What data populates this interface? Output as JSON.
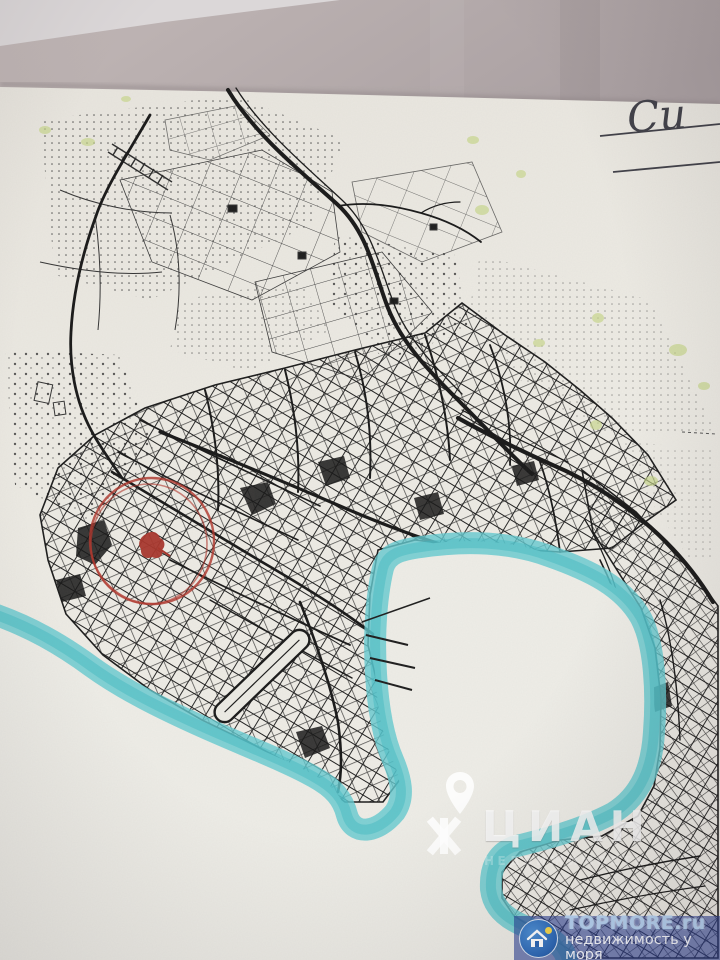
{
  "handwriting": {
    "text": "Си"
  },
  "watermarks": {
    "cian": {
      "text": "ЦИАН",
      "subtitle": "НЕДВИЖИМОСТЬ",
      "text_color": "#ffffff",
      "icons": [
        "location-pin-icon",
        "cian-logo-icon"
      ]
    },
    "topmore": {
      "site": "TOPMORE.ru",
      "tagline": "недвижимость у моря",
      "bar_color": "#2c3f94",
      "logo": "house-in-circle-icon"
    }
  },
  "map": {
    "water_highlight_color": "#5cc6cc",
    "annotation_circle_color": "#b23a31",
    "vegetation_dot_color": "#c6d687",
    "ink_color": "#1d1d1d",
    "paper_color": "#edebe4",
    "background_color": "#b2a8a9"
  }
}
